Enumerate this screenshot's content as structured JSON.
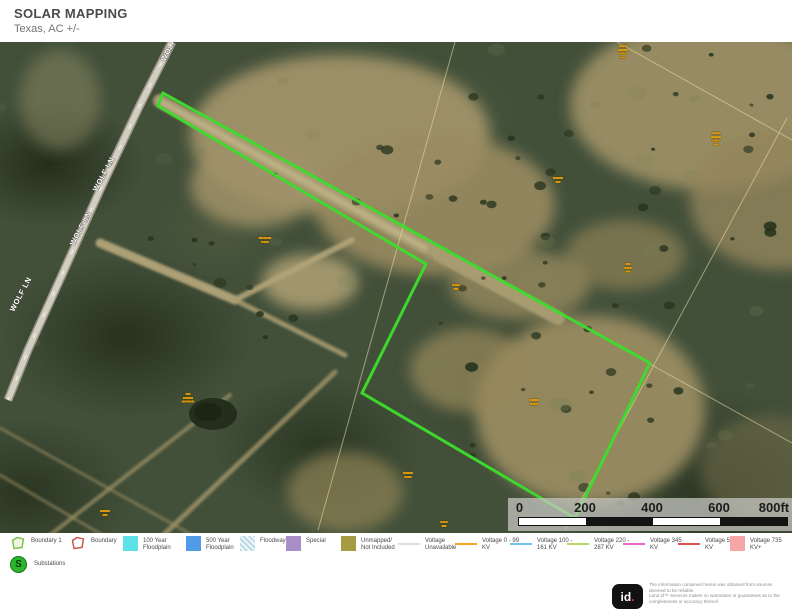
{
  "header": {
    "title": "SOLAR MAPPING",
    "subtitle": "Texas,  AC +/-"
  },
  "map": {
    "road_name": "WOLF LN",
    "road_label_positions": [
      {
        "x": 165,
        "y": 62
      },
      {
        "x": 97,
        "y": 192
      },
      {
        "x": 74,
        "y": 246
      },
      {
        "x": 14,
        "y": 312
      }
    ],
    "road_label_rotation": -62,
    "boundary": {
      "name": "Boundary 1",
      "color": "#3ddc2c",
      "points": "163,93 650,363 575,518 362,393 426,264 158,106"
    },
    "parcel_label_color": "#d7990b",
    "parcel_labels": [
      {
        "x": 623,
        "y": 46,
        "lines": [
          "▄▄▄",
          "▄▄▄▄",
          "▄▄▄",
          "▄▄"
        ]
      },
      {
        "x": 716,
        "y": 133,
        "lines": [
          "▄▄▄",
          "▄▄▄▄",
          "▄▄▄",
          "▄▄"
        ]
      },
      {
        "x": 558,
        "y": 178,
        "lines": [
          "▄▄▄▄",
          "▄▄"
        ]
      },
      {
        "x": 265,
        "y": 238,
        "lines": [
          "▄▄▄▄▄",
          "▄▄▄"
        ]
      },
      {
        "x": 628,
        "y": 264,
        "lines": [
          "▄▄",
          "▄▄▄",
          "▄▄"
        ]
      },
      {
        "x": 456,
        "y": 285,
        "lines": [
          "▄▄▄",
          "▄▄"
        ]
      },
      {
        "x": 188,
        "y": 394,
        "lines": [
          "▄▄",
          "▄▄▄▄",
          "▄▄▄▄▄"
        ]
      },
      {
        "x": 534,
        "y": 400,
        "lines": [
          "▄▄▄▄",
          "▄▄▄"
        ]
      },
      {
        "x": 408,
        "y": 473,
        "lines": [
          "▄▄▄▄",
          "▄▄▄"
        ]
      },
      {
        "x": 105,
        "y": 511,
        "lines": [
          "▄▄▄▄",
          "▄▄"
        ]
      },
      {
        "x": 444,
        "y": 522,
        "lines": [
          "▄▄▄",
          "▄▄"
        ]
      }
    ],
    "scalebar": {
      "tick_labels": [
        "0",
        "200",
        "400",
        "600",
        "800ft"
      ]
    }
  },
  "legend": {
    "items": [
      {
        "x": 10,
        "label": "Boundary 1",
        "swatch": "polygon",
        "fill": "#eef6e3",
        "stroke": "#79c044"
      },
      {
        "x": 70,
        "label": "Boundary",
        "swatch": "polygon",
        "fill": "#ffffff",
        "stroke": "#cc4b45"
      },
      {
        "x": 123,
        "label": "100 Year Floodplain",
        "swatch": "square",
        "color": "#5ce1e6"
      },
      {
        "x": 186,
        "label": "500 Year Floodplain",
        "swatch": "square",
        "color": "#4f9be8"
      },
      {
        "x": 240,
        "label": "Floodway",
        "swatch": "hatch",
        "color": "#bcd9e4"
      },
      {
        "x": 286,
        "label": "Special",
        "swatch": "square",
        "color": "#a88fc7"
      },
      {
        "x": 341,
        "label": "Unmapped/ Not Included",
        "swatch": "square",
        "color": "#a79a45"
      },
      {
        "x": 398,
        "label": "Voltage Unavailable",
        "swatch": "line",
        "color": "#dddddd"
      },
      {
        "x": 455,
        "label": "Voltage 0 - 99 KV",
        "swatch": "line",
        "color": "#f5a623"
      },
      {
        "x": 510,
        "label": "Voltage 100 - 161 KV",
        "swatch": "line",
        "color": "#6ec6f0"
      },
      {
        "x": 567,
        "label": "Voltage 220 - 287 KV",
        "swatch": "line",
        "color": "#b5d96b"
      },
      {
        "x": 623,
        "label": "Voltage 345 KV",
        "swatch": "line",
        "color": "#e86bc6"
      },
      {
        "x": 678,
        "label": "Voltage 500 KV",
        "swatch": "line",
        "color": "#e05252"
      },
      {
        "x": 730,
        "label": "Voltage  735 KV+",
        "swatch": "square",
        "color": "#f6a6a6"
      }
    ],
    "substations": {
      "label": "Substations",
      "color": "#2db52d"
    }
  },
  "disclaimer": {
    "logo": "id.",
    "lines": [
      "The information contained herein was obtained from sources",
      "deemed to be reliable.",
      " Land id™ Services makes no warranties or guarantees as to the",
      "completeness or accuracy thereof."
    ]
  }
}
